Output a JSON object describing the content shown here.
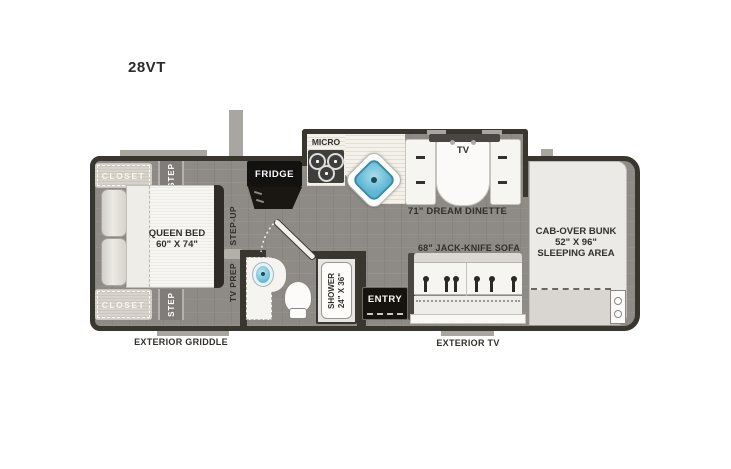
{
  "title": "28VT",
  "bedroom": {
    "closet_top": "CLOSET",
    "closet_bottom": "CLOSET",
    "step_top": "STEP",
    "step_bottom": "STEP",
    "bed_line1": "QUEEN BED",
    "bed_line2": "60\" X 74\""
  },
  "hall": {
    "step_up": "STEP-UP",
    "tv_prep": "TV PREP"
  },
  "kitchen": {
    "fridge": "FRIDGE",
    "micro": "MICRO"
  },
  "bathroom": {
    "shower_line1": "SHOWER",
    "shower_line2": "24\" X 36\""
  },
  "dinette": {
    "tv": "TV",
    "label": "71\" DREAM DINETTE"
  },
  "living": {
    "sofa": "68\" JACK-KNIFE SOFA",
    "entry": "ENTRY"
  },
  "bunk": {
    "line1": "CAB-OVER BUNK",
    "line2": "52\" X 96\"",
    "line3": "SLEEPING AREA"
  },
  "exterior": {
    "griddle": "EXTERIOR GRIDDLE",
    "tv": "EXTERIOR TV"
  },
  "colors": {
    "floor": "#8e8a85",
    "wall": "#39352f",
    "counter": "#f3f1ea",
    "furniture_white": "#f6f5f1",
    "sink_blue": "#5cb6d4",
    "exterior_tab": "#a9a6a1",
    "label_text": "#33302c",
    "appliance_black": "#141210"
  }
}
